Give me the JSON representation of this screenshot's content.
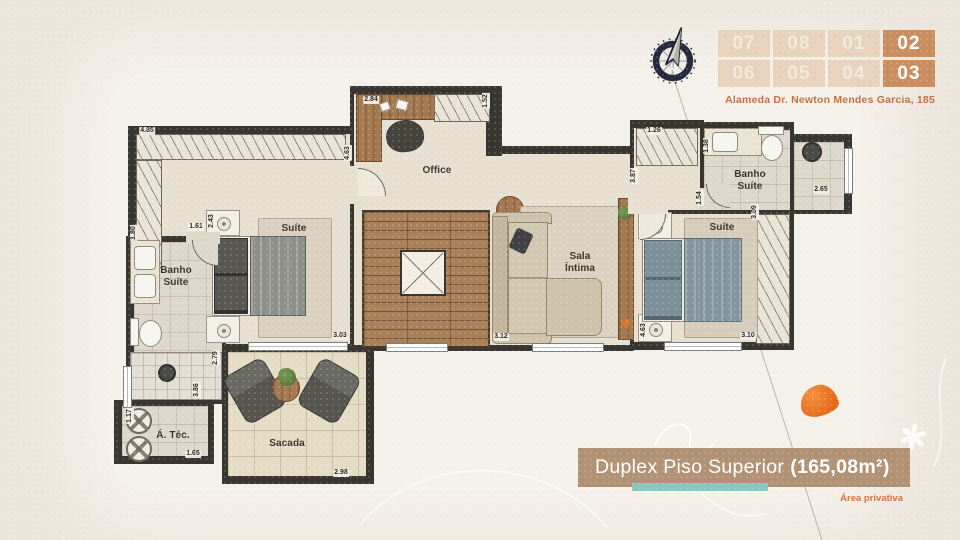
{
  "header": {
    "address": "Alameda Dr. Newton Mendes Garcia, 185",
    "units": {
      "rows": [
        [
          "07",
          "08",
          "01",
          "02"
        ],
        [
          "06",
          "05",
          "04",
          "03"
        ]
      ],
      "highlighted": [
        "02",
        "03"
      ]
    },
    "compass_letter": "N"
  },
  "banner": {
    "title": "Duplex Piso Superior",
    "area": "(165,08m²)",
    "footnote": "Área privativa"
  },
  "colors": {
    "accent_orange": "#c56f3e",
    "highlight_cell": "#c98e60",
    "banner_bg": "#b19274",
    "teal_underline": "#8ac5c0",
    "wall": "#393530"
  },
  "plan": {
    "room_labels": [
      {
        "text": "Office",
        "x": 437,
        "y": 171
      },
      {
        "text": "Suíte",
        "x": 294,
        "y": 229
      },
      {
        "text": "Banho\nSuíte",
        "x": 176,
        "y": 277
      },
      {
        "text": "Sala\nÍntima",
        "x": 580,
        "y": 263
      },
      {
        "text": "Suíte",
        "x": 722,
        "y": 228
      },
      {
        "text": "Banho\nSuíte",
        "x": 750,
        "y": 181
      },
      {
        "text": "Sacada",
        "x": 287,
        "y": 444
      },
      {
        "text": "Á. Téc.",
        "x": 173,
        "y": 436
      }
    ],
    "dimensions": [
      {
        "text": "4.85",
        "x": 147,
        "y": 131
      },
      {
        "text": "1.80",
        "x": 134,
        "y": 233,
        "v": true
      },
      {
        "text": "4.63",
        "x": 348,
        "y": 153,
        "v": true
      },
      {
        "text": "2.84",
        "x": 371,
        "y": 100
      },
      {
        "text": "1.52",
        "x": 486,
        "y": 101,
        "v": true
      },
      {
        "text": "2.43",
        "x": 212,
        "y": 221,
        "v": true
      },
      {
        "text": "1.61",
        "x": 196,
        "y": 227
      },
      {
        "text": "3.03",
        "x": 340,
        "y": 336
      },
      {
        "text": "3.12",
        "x": 501,
        "y": 337
      },
      {
        "text": "2.79",
        "x": 216,
        "y": 358,
        "v": true
      },
      {
        "text": "3.86",
        "x": 197,
        "y": 390,
        "v": true
      },
      {
        "text": "1.17",
        "x": 130,
        "y": 416,
        "v": true
      },
      {
        "text": "1.65",
        "x": 193,
        "y": 454
      },
      {
        "text": "2.98",
        "x": 341,
        "y": 473
      },
      {
        "text": "1.26",
        "x": 654,
        "y": 131
      },
      {
        "text": "1.38",
        "x": 707,
        "y": 146,
        "v": true
      },
      {
        "text": "3.87",
        "x": 634,
        "y": 176,
        "v": true
      },
      {
        "text": "1.54",
        "x": 700,
        "y": 198,
        "v": true
      },
      {
        "text": "2.65",
        "x": 821,
        "y": 190
      },
      {
        "text": "3.09",
        "x": 755,
        "y": 212,
        "v": true
      },
      {
        "text": "4.63",
        "x": 644,
        "y": 330,
        "v": true
      },
      {
        "text": "3.10",
        "x": 748,
        "y": 336
      }
    ]
  }
}
